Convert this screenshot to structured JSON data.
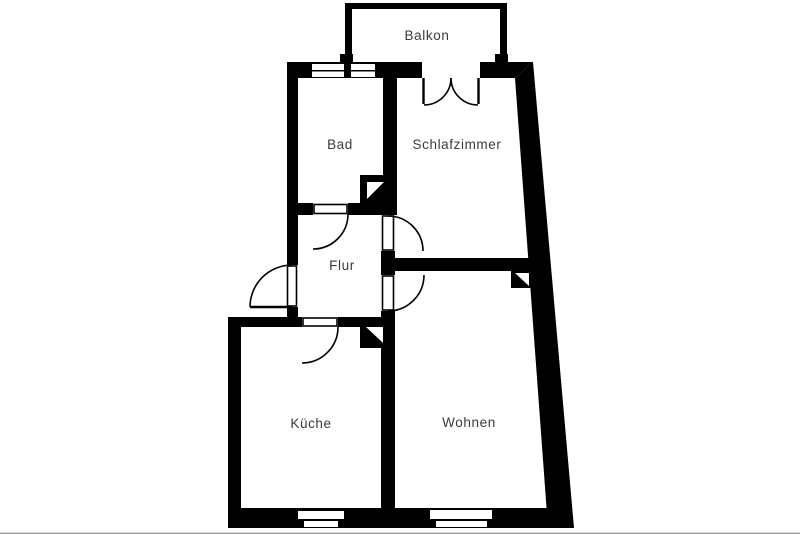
{
  "document": {
    "type": "floor-plan"
  },
  "colors": {
    "walls": "#000000",
    "background": "#ffffff",
    "label_text": "#3a3a3a",
    "bottom_edge": "#a6a6a6"
  },
  "rooms": {
    "balkon": {
      "label": "Balkon"
    },
    "bad": {
      "label": "Bad"
    },
    "schlafzimmer": {
      "label": "Schlafzimmer"
    },
    "flur": {
      "label": "Flur"
    },
    "kueche": {
      "label": "Küche"
    },
    "wohnen": {
      "label": "Wohnen"
    }
  }
}
